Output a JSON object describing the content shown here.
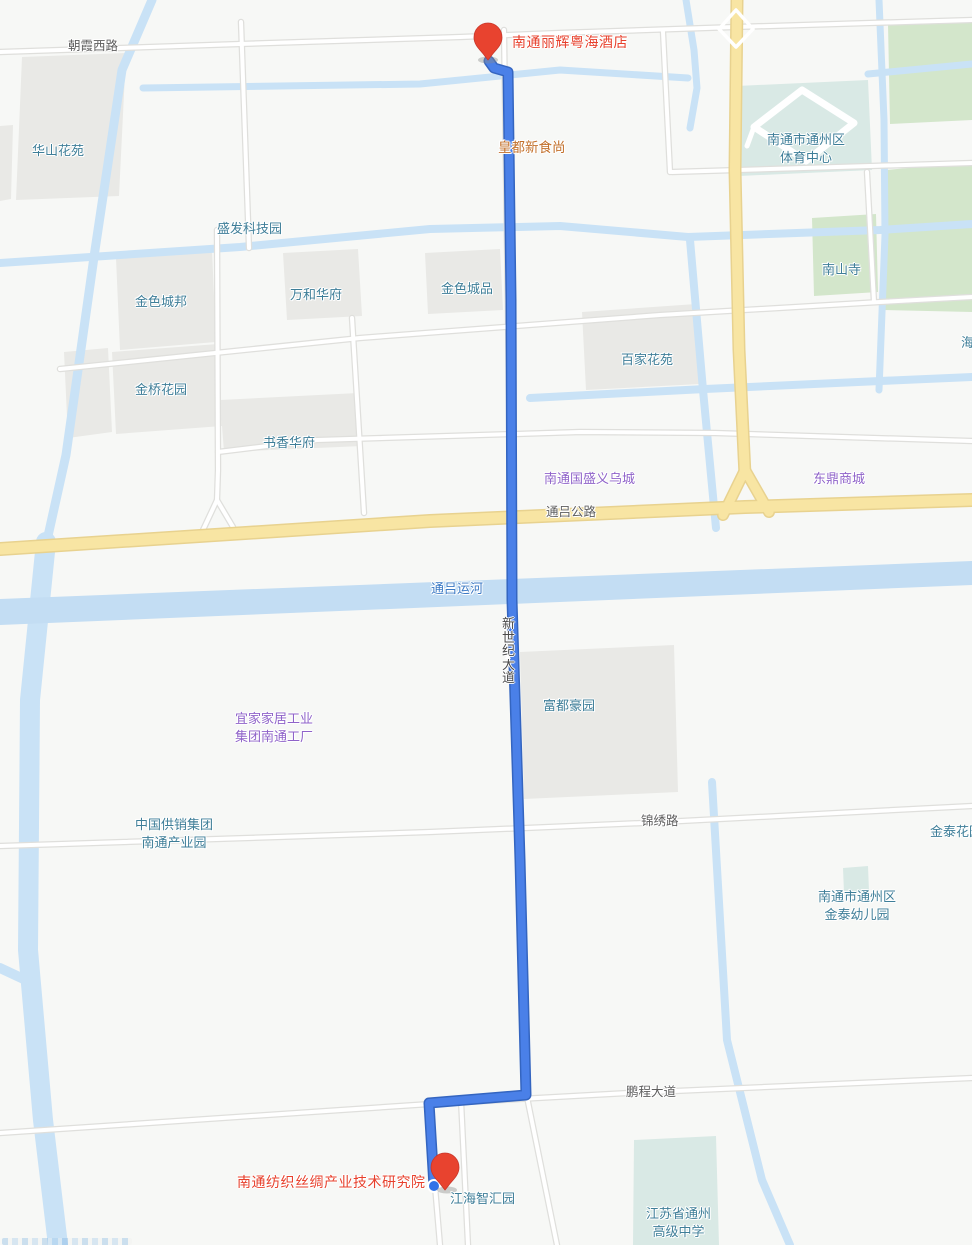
{
  "pins": {
    "start": {
      "label": "南通丽辉粤海酒店",
      "color": "#E8432F"
    },
    "end": {
      "label": "南通纺织丝绸产业技术研究院",
      "color": "#E8432F"
    }
  },
  "route": {
    "road_label": "新世纪大道",
    "color": "#4A80E8"
  },
  "road_labels": {
    "chaoxia": "朝霞西路",
    "tonglv_highway": "通吕公路",
    "jinxiu": "锦绣路",
    "pengcheng": "鹏程大道"
  },
  "water_labels": {
    "tonglv_canal": "通吕运河"
  },
  "poi_labels": {
    "huashan": "华山花苑",
    "shengfa": "盛发科技园",
    "jinsechengbang": "金色城邦",
    "wanhe": "万和华府",
    "jinsechengpin": "金色城品",
    "jinqiao": "金桥花园",
    "shuxiang": "书香华府",
    "baijia": "百家花苑",
    "nanshansi": "南山寺",
    "fudu": "富都豪园",
    "jianghai": "江海智汇园",
    "jintai_garden": "金泰花园",
    "partial_right": "海"
  },
  "poi_labels_2line": {
    "sports_center": {
      "line1": "南通市通州区",
      "line2": "体育中心"
    },
    "gongxiao": {
      "line1": "中国供销集团",
      "line2": "南通产业园"
    },
    "jintai_kg": {
      "line1": "南通市通州区",
      "line2": "金泰幼儿园"
    },
    "tongzhou_school": {
      "line1": "江苏省通州",
      "line2": "高级中学"
    }
  },
  "business_labels": {
    "guosheng": "南通国盛义乌城",
    "dongding": "东鼎商城",
    "huangdu": "皇都新食尚",
    "ikea": {
      "line1": "宜家家居工业",
      "line2": "集团南通工厂"
    }
  },
  "colors": {
    "background": "#F7F8F6",
    "water": "#C9E2F6",
    "canal_fill": "#C3DDF3",
    "road_fill": "#FFFFFF",
    "road_casing": "#DFDFDC",
    "yellow_road_fill": "#F8E5A3",
    "yellow_road_casing": "#E8D28F",
    "block_fill": "#E9E9E6",
    "park_green": "#D3E6CB",
    "campus_teal": "#D9E9E5",
    "route_blue": "#4A80E8",
    "route_casing": "#3465C0",
    "poi_text": "#3E7E98",
    "business_text": "#8F63C9",
    "destination_text": "#E7402C"
  }
}
